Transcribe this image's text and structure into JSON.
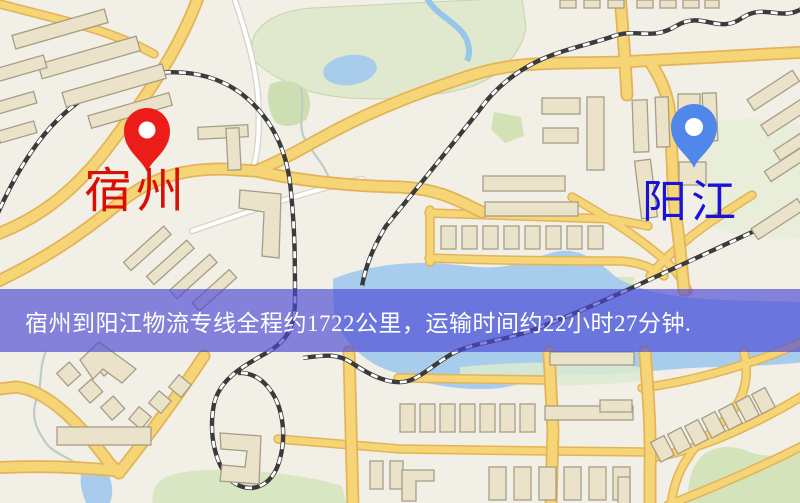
{
  "banner": {
    "text": "宿州到阳江物流专线全程约1722公里，运输时间约22小时27分钟.",
    "background": "rgba(75,72,212,0.66)",
    "text_color": "#ffffff"
  },
  "markers": {
    "origin": {
      "label": "宿州",
      "label_color": "#d90f04",
      "pin_color": "#ec1c18",
      "pin_hole_color": "#ffffff"
    },
    "destination": {
      "label": "阳江",
      "label_color": "#1b12da",
      "pin_color": "#4f87ea",
      "pin_hole_color": "#ffffff"
    }
  },
  "map_palette": {
    "background": "#f2efe6",
    "road_fill": "#f6d577",
    "road_edge": "#e3b457",
    "building_fill": "#ebe3c9",
    "building_outline": "#a69d87",
    "water": "#a8cdec",
    "park": "#e0e9cd",
    "railway": "#3b3b3b"
  }
}
